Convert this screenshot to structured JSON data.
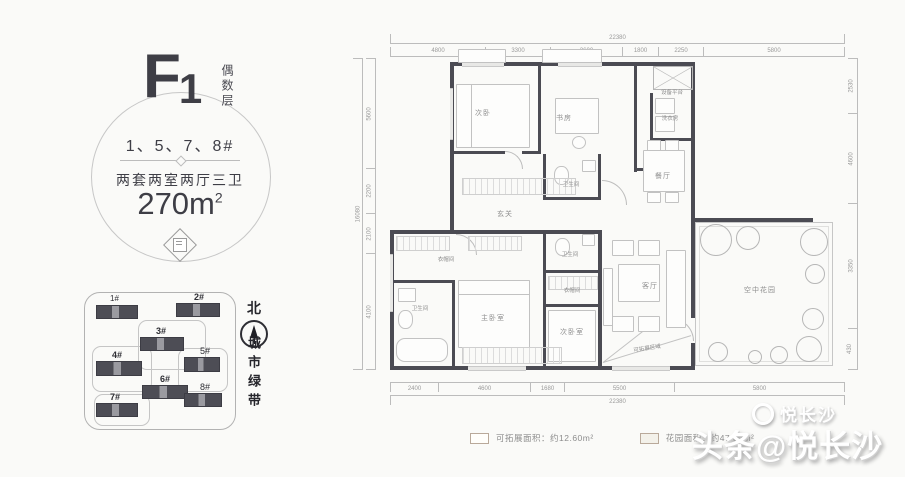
{
  "info_panel": {
    "code_f": "F",
    "code_num": "1",
    "floor_vertical": "偶数层",
    "buildings": "1、5、7、8#",
    "layout_desc": "两套两室两厅三卫",
    "area_value": "270m",
    "area_sup": "2"
  },
  "site_plan": {
    "north": "北",
    "green_belt": "城市绿带",
    "buildings": [
      {
        "label": "1#"
      },
      {
        "label": "2#"
      },
      {
        "label": "3#"
      },
      {
        "label": "4#"
      },
      {
        "label": "5#"
      },
      {
        "label": "6#"
      },
      {
        "label": "7#"
      },
      {
        "label": "8#"
      }
    ]
  },
  "floor_plan": {
    "rooms": [
      {
        "label": "次卧"
      },
      {
        "label": "书房"
      },
      {
        "label": "餐厅"
      },
      {
        "label": "玄关"
      },
      {
        "label": "洗衣房"
      },
      {
        "label": "设备平台"
      },
      {
        "label": "卫生间"
      },
      {
        "label": "衣帽间"
      },
      {
        "label": "卫生间"
      },
      {
        "label": "主卧室"
      },
      {
        "label": "卫生间"
      },
      {
        "label": "衣帽间"
      },
      {
        "label": "次卧室"
      },
      {
        "label": "客厅"
      },
      {
        "label": "空中花园"
      },
      {
        "label": "可拓展区域"
      }
    ],
    "dims": {
      "top": {
        "total": "22380",
        "segments": [
          "4800",
          "3300",
          "3600",
          "1800",
          "2250",
          "5800"
        ]
      },
      "bottom": {
        "total": "22380",
        "segments": [
          "2400",
          "4600",
          "1680",
          "5500",
          "5800"
        ]
      },
      "left": {
        "total": "16080",
        "segments": [
          "5600",
          "2200",
          "2100",
          "4100"
        ]
      },
      "right": {
        "segments": [
          "2530",
          "4600",
          "3350",
          "430"
        ]
      }
    }
  },
  "legend": {
    "items": [
      {
        "label": "可拓展面积：约12.60m²"
      },
      {
        "label": "花园面积：约47.82m²"
      }
    ]
  },
  "watermark": {
    "small": "悦长沙",
    "main": "头条@悦长沙"
  }
}
